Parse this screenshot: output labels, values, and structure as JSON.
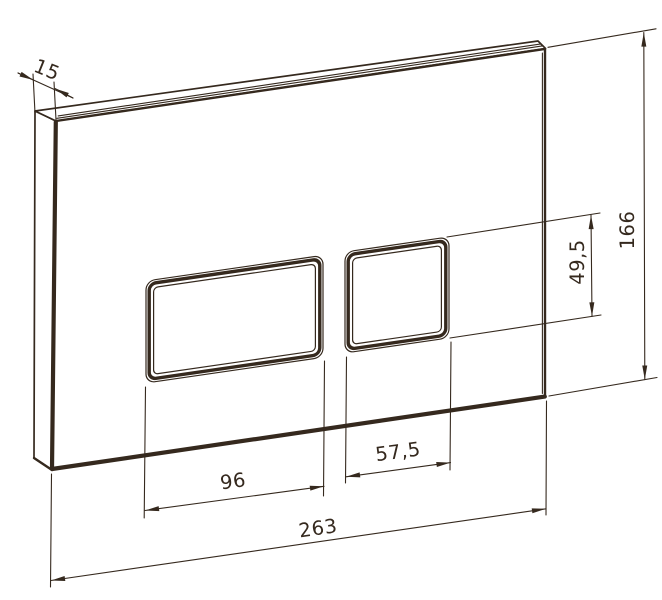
{
  "colors": {
    "line": "#35291e",
    "background": "#ffffff"
  },
  "drawing": {
    "kind": "technical-dimension-drawing",
    "subject": "flush-plate-with-two-buttons",
    "dimensions": {
      "plate_thickness": "15",
      "plate_height": "166",
      "button_cutout_height": "49,5",
      "large_button_width": "96",
      "small_button_width": "57,5",
      "plate_width": "263"
    }
  }
}
